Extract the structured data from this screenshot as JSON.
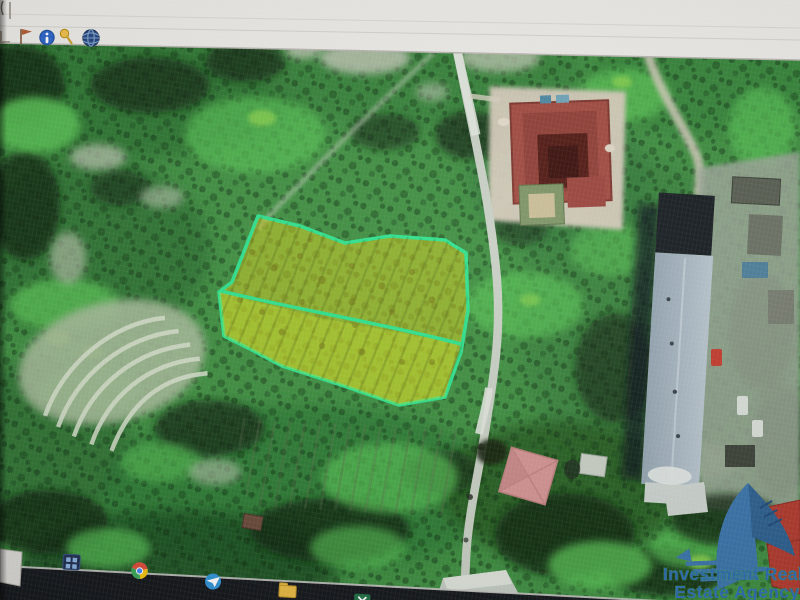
{
  "toolbar": {
    "icons": [
      "ruler-icon",
      "flag-icon",
      "info-icon",
      "pushpin-icon",
      "globe-icon"
    ]
  },
  "map": {
    "imagery": "satellite",
    "road_color": "#c7cec3",
    "parcel": {
      "fill_color": "rgba(213,206,27,0.52)",
      "border_color": "#2ee08c",
      "sections": 2
    }
  },
  "watermark": {
    "line1": "Investment Real",
    "line2": "Estate Agency",
    "text_color": "#2e6cb0",
    "glow_color": "#3aa04a",
    "logo_color": "#3a74aa"
  },
  "taskbar": {
    "icons": [
      "start-icon",
      "chrome-icon",
      "telegram-icon",
      "file-explorer-icon",
      "excel-icon",
      "word-icon",
      "skype-icon"
    ]
  }
}
